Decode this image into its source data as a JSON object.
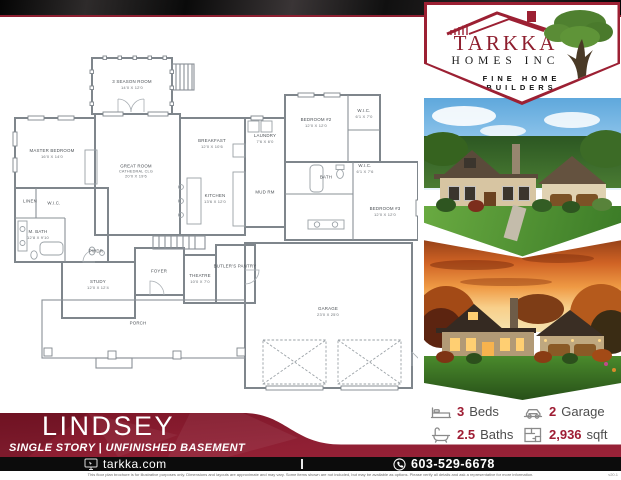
{
  "logo": {
    "company": "TARKKA",
    "company_sub": "HOMES INC",
    "tagline": "FINE HOME BUILDERS"
  },
  "banner": {
    "plan_name": "LINDSEY",
    "subtitle": "SINGLE STORY | UNFINISHED BASEMENT"
  },
  "stats": {
    "beds": {
      "value": "3",
      "label": "Beds"
    },
    "garage": {
      "value": "2",
      "label": "Garage"
    },
    "baths": {
      "value": "2.5",
      "label": "Baths"
    },
    "sqft": {
      "value": "2,936",
      "label": "sqft"
    }
  },
  "footer": {
    "website": "tarkka.com",
    "phone": "603-529-6678",
    "disclaimer": "This floor plan brochure is for illustrative purposes only. Dimensions and layouts are approximate and may vary. Some items shown are not included, but may be available as options. Please verify all details and ask a representative for more information.",
    "version": "v20.1"
  },
  "colors": {
    "maroon": "#8c2034",
    "logo_red": "#9c2033",
    "black_bar": "#0c0c0c",
    "tree_green": "#55862f",
    "stat_number": "#9e1c33"
  },
  "floor_plan": {
    "rooms": [
      {
        "name": "3 SEASON ROOM",
        "dims": "14'0 X 12'0",
        "x": 124,
        "y": 62
      },
      {
        "name": "MASTER BEDROOM",
        "dims": "16'0 X 14'0",
        "x": 44,
        "y": 131
      },
      {
        "name": "GREAT ROOM",
        "note": "CATHEDRAL CLG",
        "dims": "20'0 X 19'6",
        "x": 128,
        "y": 149
      },
      {
        "name": "BREAKFAST",
        "dims": "12'0 X 10'6",
        "x": 204,
        "y": 121
      },
      {
        "name": "KITCHEN",
        "dims": "13'6 X 12'0",
        "x": 207,
        "y": 176
      },
      {
        "name": "LAUNDRY",
        "dims": "7'6 X 6'0",
        "x": 257,
        "y": 116
      },
      {
        "name": "MUD RM",
        "x": 257,
        "y": 170
      },
      {
        "name": "BEDROOM #2",
        "dims": "12'0 X 12'0",
        "x": 308,
        "y": 100
      },
      {
        "name": "W.I.C.",
        "dims": "6'1 X 7'0",
        "x": 356,
        "y": 91
      },
      {
        "name": "BATH",
        "x": 318,
        "y": 155
      },
      {
        "name": "W.I.C.",
        "dims": "6'1 X 7'6",
        "x": 357,
        "y": 146
      },
      {
        "name": "BEDROOM #3",
        "dims": "12'0 X 12'0",
        "x": 377,
        "y": 189
      },
      {
        "name": "LINEN",
        "x": 22,
        "y": 179
      },
      {
        "name": "W.I.C.",
        "x": 46,
        "y": 181
      },
      {
        "name": "M. BATH",
        "dims": "12'8 X 9'10",
        "x": 30,
        "y": 212
      },
      {
        "name": "PWDR",
        "x": 88,
        "y": 229
      },
      {
        "name": "STUDY",
        "dims": "12'0 X 12'4",
        "x": 90,
        "y": 262
      },
      {
        "name": "FOYER",
        "x": 151,
        "y": 249
      },
      {
        "name": "THEATRE",
        "dims": "10'0 X 7'0",
        "x": 192,
        "y": 256
      },
      {
        "name": "BUTLER'S PANTRY",
        "x": 227,
        "y": 244
      },
      {
        "name": "PORCH",
        "x": 130,
        "y": 301
      },
      {
        "name": "GARAGE",
        "dims": "23'0 X 25'0",
        "x": 320,
        "y": 289
      }
    ]
  }
}
